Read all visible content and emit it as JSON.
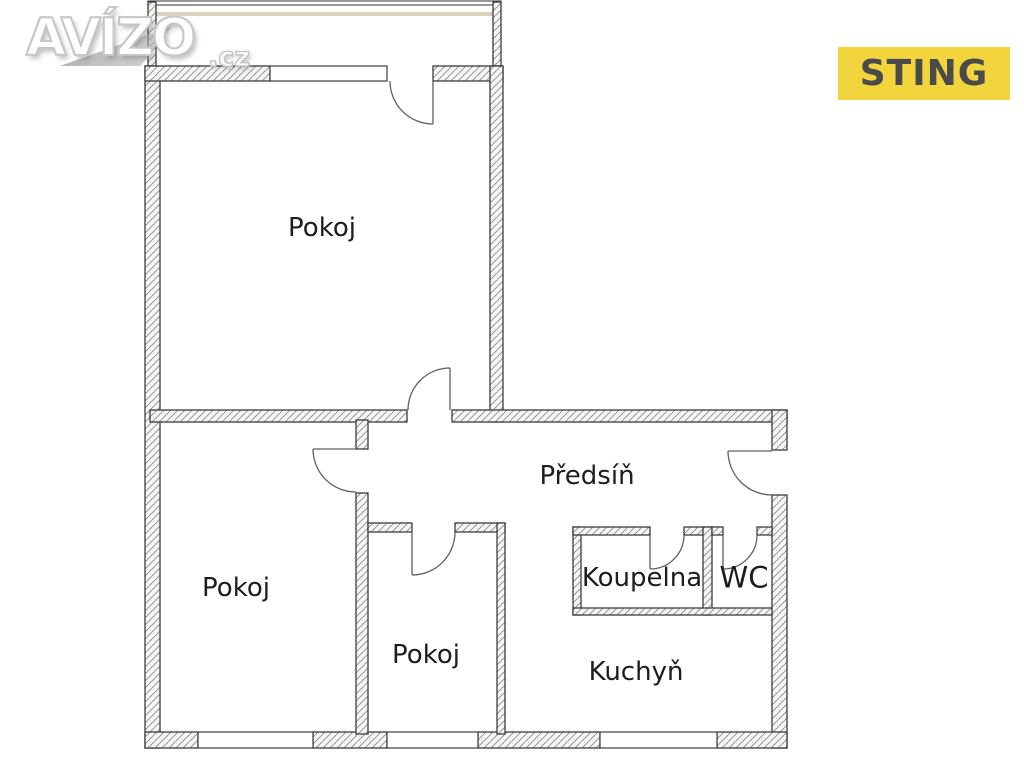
{
  "watermark": {
    "brand": "AVÍZO",
    "tld": ".cz"
  },
  "badge": {
    "label": "STING"
  },
  "rooms": {
    "room_top": "Pokoj",
    "room_left": "Pokoj",
    "room_middle": "Pokoj",
    "hallway": "Předsíň",
    "bathroom": "Koupelna",
    "wc": "WC",
    "kitchen": "Kuchyň"
  },
  "colors": {
    "badge_bg": "#F2D43D",
    "badge_text": "#4A4A4A",
    "wall_outline": "#3C3C3C",
    "wall_fill": "#F5F5F5",
    "hatch": "#8C8C8C",
    "door": "#5F5F5F",
    "label_text": "#1D1D1D",
    "balcony_accent": "#D8D3BE",
    "logo_outline": "#C6C6C6"
  }
}
